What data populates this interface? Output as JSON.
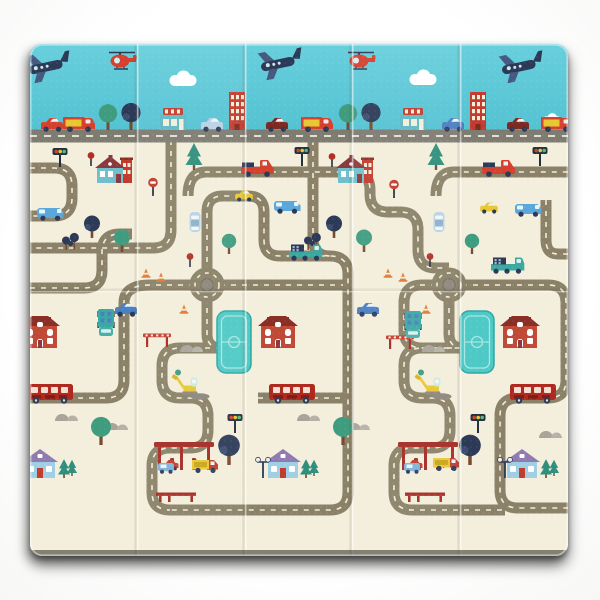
{
  "scene": {
    "description": "Product photo of a foldable baby play mat printed with a toy-town road map: blue sky band with planes, helicopters and shops, cream ground with an olive road maze, roundabouts, houses, buses, a gas station, pools and an excavator.",
    "background": "#ffffff"
  },
  "mat": {
    "x": 30,
    "y": 44,
    "w": 538,
    "h": 512,
    "radius": 12,
    "sky_bottom": 131,
    "highway_y": 136,
    "fold_xs": [
      137,
      245,
      352,
      460
    ],
    "crease_y": 290
  },
  "palette": {
    "sky_top": "#68cfdc",
    "sky_bottom": "#54c2d2",
    "cream": "#f4efdc",
    "highway": "#7e7b71",
    "road": "#8b8168",
    "road_dash": "#f2ecd8",
    "red": "#d6402e",
    "dark_red": "#a52c23",
    "brick": "#bf4a35",
    "navy": "#2c3a57",
    "teal": "#3aa9a2",
    "green": "#3f9c7e",
    "pine": "#2f8f7c",
    "yellow": "#e8c832",
    "pool": "#4fc9c5",
    "hill_gray": "#a8a49a",
    "trunk": "#7a4a30",
    "shadow": "#1c1a15"
  },
  "roads": {
    "highway_d": "M30,136 H568",
    "paths": [
      "M30,168 H54 Q72,168 72,186 V198 Q72,216 54,216 H30",
      "M171,140 V230 Q171,248 153,248 H30",
      "M30,288 H84 Q102,288 102,270 V252 Q102,234 120,234 H132",
      "M188,196 Q188,172 206,172 H352",
      "M436,196 Q436,172 454,172 H568",
      "M568,254 H558 Q546,254 546,240 V200",
      "M313,140 V238 Q313,256 330,256",
      "M207,273 V212 Q207,196 223,196 H248 Q264,196 264,212 V240 Q264,256 280,256 H330 Q348,256 348,274 V492 Q348,510 330,510 H170",
      "M352,172 Q370,172 370,190 V194 Q370,212 388,212 H400 Q418,212 418,230 V250 Q418,268 436,268 H449",
      "M207,297 V334 Q207,348 221,348",
      "M221,348 H180 Q162,348 162,366 V380 Q162,398 180,398 H190 Q208,398 208,416 V430 Q208,448 190,448 H170 Q152,448 152,466 V492 Q152,510 170,510",
      "M194,285 H150 Q124,285 124,303 V380 Q124,398 106,398 H30",
      "M220,285 H343",
      "M258,398 H343",
      "M436,285 H422 Q404,285 404,303 V330 Q404,348 422,348 H463",
      "M449,297 V334 Q449,348 463,348",
      "M463,348 H422 Q404,348 404,366 V380 Q404,398 422,398 H432 Q450,398 450,416 V430 Q450,448 432,448 H412 Q394,448 394,466 V492 Q394,510 412,510 H505",
      "M462,285 H548 Q566,285 566,303 V380 Q566,398 548,398 H518 Q500,398 500,416 V490 Q500,508 518,508 H568"
    ]
  },
  "roundabouts": [
    {
      "x": 207,
      "y": 285
    },
    {
      "x": 449,
      "y": 285
    }
  ],
  "sky_elements": [
    {
      "t": "cloud",
      "x": 183,
      "y": 86
    },
    {
      "t": "cloud",
      "x": 423,
      "y": 85
    },
    {
      "t": "cloud",
      "x": 552,
      "y": 124,
      "s": 0.7
    },
    {
      "t": "plane",
      "x": 50,
      "y": 82
    },
    {
      "t": "plane",
      "x": 282,
      "y": 79
    },
    {
      "t": "plane",
      "x": 523,
      "y": 82
    },
    {
      "t": "heli",
      "x": 122,
      "y": 70
    },
    {
      "t": "heli",
      "x": 361,
      "y": 70
    },
    {
      "t": "treeRound",
      "x": 108,
      "y": 130,
      "s": 1.15
    },
    {
      "t": "treeDark",
      "x": 131,
      "y": 130,
      "s": 1.2
    },
    {
      "t": "treeRound",
      "x": 348,
      "y": 130,
      "s": 1.15
    },
    {
      "t": "treeDark",
      "x": 371,
      "y": 130,
      "s": 1.2
    },
    {
      "t": "shop",
      "x": 173,
      "y": 130
    },
    {
      "t": "shop",
      "x": 413,
      "y": 130
    },
    {
      "t": "tower",
      "x": 237,
      "y": 130
    },
    {
      "t": "tower",
      "x": 478,
      "y": 130
    },
    {
      "t": "carSide",
      "x": 52,
      "y": 131,
      "c": "#d6402e"
    },
    {
      "t": "boxVan",
      "x": 79,
      "y": 131
    },
    {
      "t": "carSide",
      "x": 212,
      "y": 131,
      "c": "#b9d2e4"
    },
    {
      "t": "carSide",
      "x": 277,
      "y": 131,
      "c": "#7e2a22"
    },
    {
      "t": "boxVan",
      "x": 317,
      "y": 131
    },
    {
      "t": "carSide",
      "x": 453,
      "y": 131,
      "c": "#4a7fc1"
    },
    {
      "t": "carSide",
      "x": 518,
      "y": 131,
      "c": "#7e2a22"
    },
    {
      "t": "boxVan",
      "x": 557,
      "y": 131
    }
  ],
  "ground_elements": [
    {
      "t": "pool",
      "x": 234,
      "y": 373
    },
    {
      "t": "pool",
      "x": 477,
      "y": 373
    },
    {
      "t": "hills",
      "x": 193,
      "y": 352
    },
    {
      "t": "hills",
      "x": 435,
      "y": 352
    },
    {
      "t": "hills",
      "x": 68,
      "y": 421
    },
    {
      "t": "hills",
      "x": 310,
      "y": 421
    },
    {
      "t": "hills",
      "x": 118,
      "y": 430
    },
    {
      "t": "hills",
      "x": 360,
      "y": 430
    },
    {
      "t": "hills",
      "x": 552,
      "y": 438
    },
    {
      "t": "dirt",
      "x": 200,
      "y": 398
    },
    {
      "t": "dirt",
      "x": 442,
      "y": 398
    },
    {
      "t": "bench",
      "x": 176,
      "y": 502
    },
    {
      "t": "bench",
      "x": 425,
      "y": 502
    },
    {
      "t": "crossGate",
      "x": 157,
      "y": 347
    },
    {
      "t": "crossGate",
      "x": 400,
      "y": 349
    },
    {
      "t": "houseVictorian",
      "x": 111,
      "y": 183
    },
    {
      "t": "houseVictorian",
      "x": 352,
      "y": 183
    },
    {
      "t": "houseBrick",
      "x": 40,
      "y": 348
    },
    {
      "t": "houseBrick",
      "x": 278,
      "y": 348
    },
    {
      "t": "houseBrick",
      "x": 520,
      "y": 348
    },
    {
      "t": "houseCottage",
      "x": 40,
      "y": 478
    },
    {
      "t": "houseCottage",
      "x": 283,
      "y": 478
    },
    {
      "t": "houseCottage",
      "x": 522,
      "y": 478
    },
    {
      "t": "treePine",
      "x": 194,
      "y": 170
    },
    {
      "t": "treePine",
      "x": 436,
      "y": 170
    },
    {
      "t": "treePine",
      "x": 64,
      "y": 478,
      "s": 0.7
    },
    {
      "t": "treePine",
      "x": 72,
      "y": 476,
      "s": 0.6
    },
    {
      "t": "treePine",
      "x": 306,
      "y": 478,
      "s": 0.7
    },
    {
      "t": "treePine",
      "x": 314,
      "y": 476,
      "s": 0.6
    },
    {
      "t": "treePine",
      "x": 546,
      "y": 478,
      "s": 0.7
    },
    {
      "t": "treePine",
      "x": 554,
      "y": 476,
      "s": 0.6
    },
    {
      "t": "treeRound",
      "x": 122,
      "y": 252
    },
    {
      "t": "treeRound",
      "x": 364,
      "y": 252
    },
    {
      "t": "treeRound",
      "x": 229,
      "y": 254,
      "s": 0.9
    },
    {
      "t": "treeRound",
      "x": 472,
      "y": 254,
      "s": 0.9
    },
    {
      "t": "treeRound",
      "x": 101,
      "y": 445,
      "s": 1.25
    },
    {
      "t": "treeRound",
      "x": 343,
      "y": 445,
      "s": 1.25
    },
    {
      "t": "treeDark",
      "x": 92,
      "y": 238
    },
    {
      "t": "treeDark",
      "x": 334,
      "y": 238
    },
    {
      "t": "treeDark",
      "x": 229,
      "y": 465,
      "s": 1.35
    },
    {
      "t": "treeDark",
      "x": 470,
      "y": 465,
      "s": 1.35
    },
    {
      "t": "smallPair",
      "x": 70,
      "y": 250
    },
    {
      "t": "smallPair",
      "x": 312,
      "y": 250
    },
    {
      "t": "lamp",
      "x": 263,
      "y": 478
    },
    {
      "t": "lamp",
      "x": 505,
      "y": 478
    },
    {
      "t": "gasStation",
      "x": 184,
      "y": 470
    },
    {
      "t": "gasStation",
      "x": 428,
      "y": 470
    },
    {
      "t": "miniVan",
      "x": 166,
      "y": 473
    },
    {
      "t": "miniVan",
      "x": 412,
      "y": 473
    },
    {
      "t": "miniTruck",
      "x": 205,
      "y": 472
    },
    {
      "t": "miniTruck",
      "x": 446,
      "y": 470
    },
    {
      "t": "excavator",
      "x": 190,
      "y": 395
    },
    {
      "t": "excavator",
      "x": 433,
      "y": 395
    },
    {
      "t": "bus",
      "x": 50,
      "y": 402
    },
    {
      "t": "bus",
      "x": 292,
      "y": 402
    },
    {
      "t": "bus",
      "x": 533,
      "y": 402
    },
    {
      "t": "van",
      "x": 50,
      "y": 220
    },
    {
      "t": "van",
      "x": 287,
      "y": 213
    },
    {
      "t": "van",
      "x": 528,
      "y": 216
    },
    {
      "t": "pickup",
      "x": 258,
      "y": 176
    },
    {
      "t": "pickup",
      "x": 499,
      "y": 176
    },
    {
      "t": "carSide",
      "x": 244,
      "y": 201,
      "c": "#e8c832",
      "s": 0.8
    },
    {
      "t": "carSide",
      "x": 489,
      "y": 213,
      "c": "#e8c832",
      "s": 0.8
    },
    {
      "t": "sedanVert",
      "x": 195,
      "y": 232
    },
    {
      "t": "sedanVert",
      "x": 439,
      "y": 232
    },
    {
      "t": "truckFlat",
      "x": 305,
      "y": 260
    },
    {
      "t": "truckFlat",
      "x": 507,
      "y": 273
    },
    {
      "t": "truckBoxV",
      "x": 106,
      "y": 336
    },
    {
      "t": "truckBoxV",
      "x": 413,
      "y": 338
    },
    {
      "t": "carSide",
      "x": 126,
      "y": 316,
      "c": "#4a7fc1"
    },
    {
      "t": "carSide",
      "x": 368,
      "y": 316,
      "c": "#4a7fc1"
    },
    {
      "t": "trafficLight",
      "x": 60,
      "y": 167
    },
    {
      "t": "trafficLight",
      "x": 302,
      "y": 166
    },
    {
      "t": "trafficLight",
      "x": 540,
      "y": 166
    },
    {
      "t": "trafficLight",
      "x": 235,
      "y": 433
    },
    {
      "t": "trafficLight",
      "x": 478,
      "y": 433
    },
    {
      "t": "stopSign",
      "x": 153,
      "y": 196
    },
    {
      "t": "stopSign",
      "x": 394,
      "y": 198
    },
    {
      "t": "signDot",
      "x": 91,
      "y": 166
    },
    {
      "t": "signDot",
      "x": 332,
      "y": 167
    },
    {
      "t": "signDot",
      "x": 190,
      "y": 267
    },
    {
      "t": "signDot",
      "x": 430,
      "y": 267
    },
    {
      "t": "cone",
      "x": 146,
      "y": 277
    },
    {
      "t": "cone",
      "x": 161,
      "y": 281
    },
    {
      "t": "cone",
      "x": 184,
      "y": 313
    },
    {
      "t": "cone",
      "x": 388,
      "y": 277
    },
    {
      "t": "cone",
      "x": 403,
      "y": 281
    },
    {
      "t": "cone",
      "x": 426,
      "y": 313
    }
  ]
}
